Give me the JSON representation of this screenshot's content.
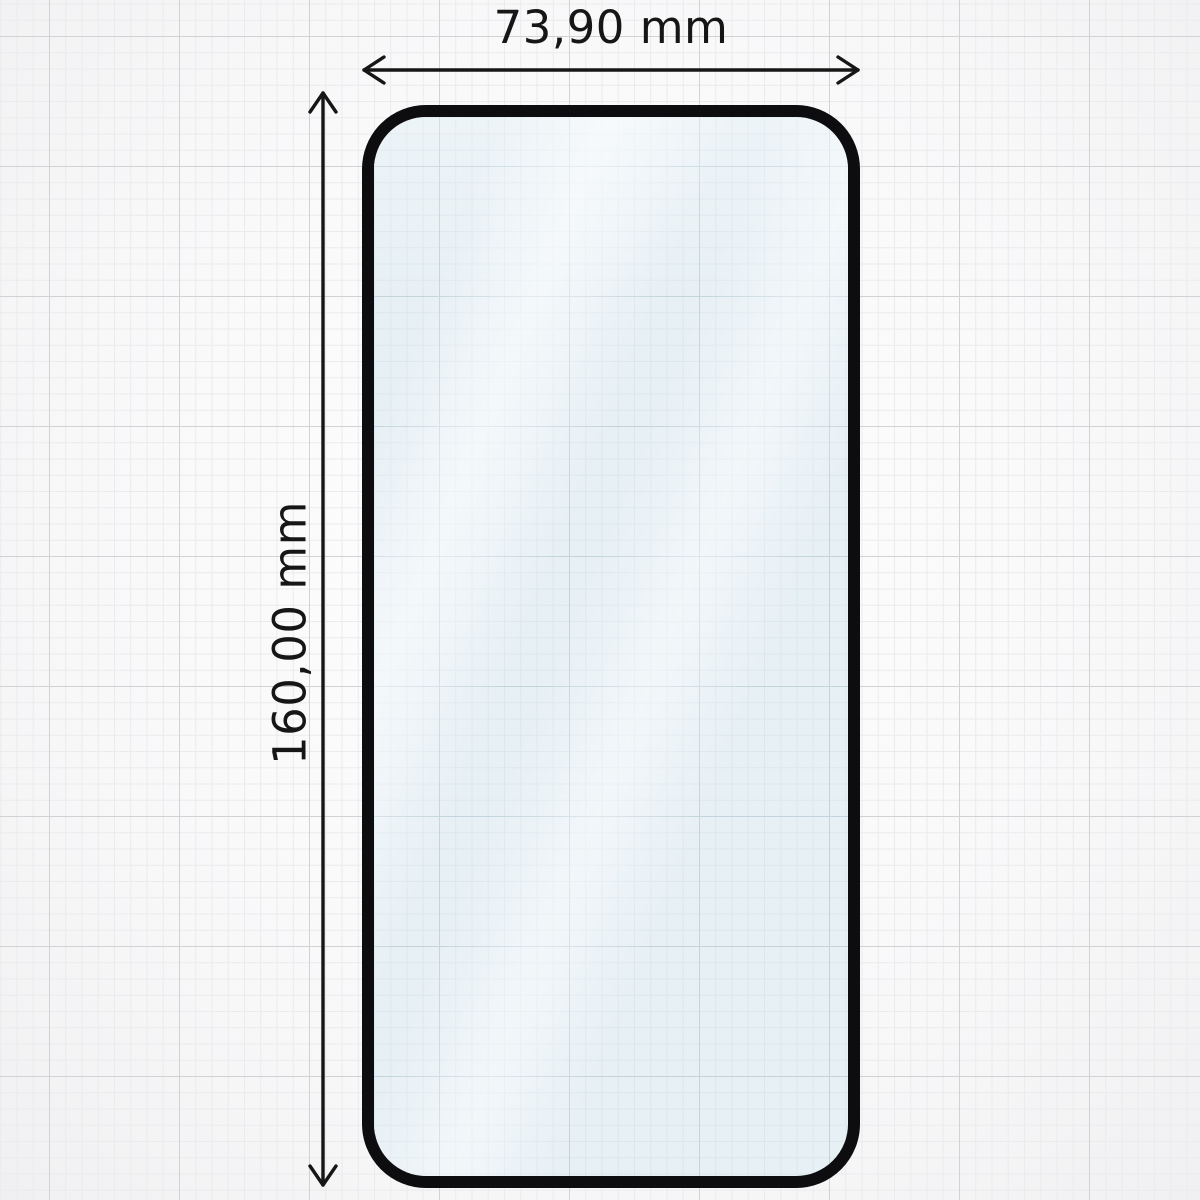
{
  "diagram": {
    "subject": "tempered-glass-screen-protector",
    "width_dimension": {
      "label": "73,90 mm"
    },
    "height_dimension": {
      "label": "160,00 mm"
    },
    "colors": {
      "outline": "#0d0d10",
      "glass": "#e7f0f5",
      "glass_grid_minor": "#dbe7ec",
      "glass_grid_major": "#c3d4dc",
      "dimension": "#161616",
      "paper": "#fafafa",
      "grid_minor": "#ebebed",
      "grid_major": "#d2d2d6"
    }
  }
}
